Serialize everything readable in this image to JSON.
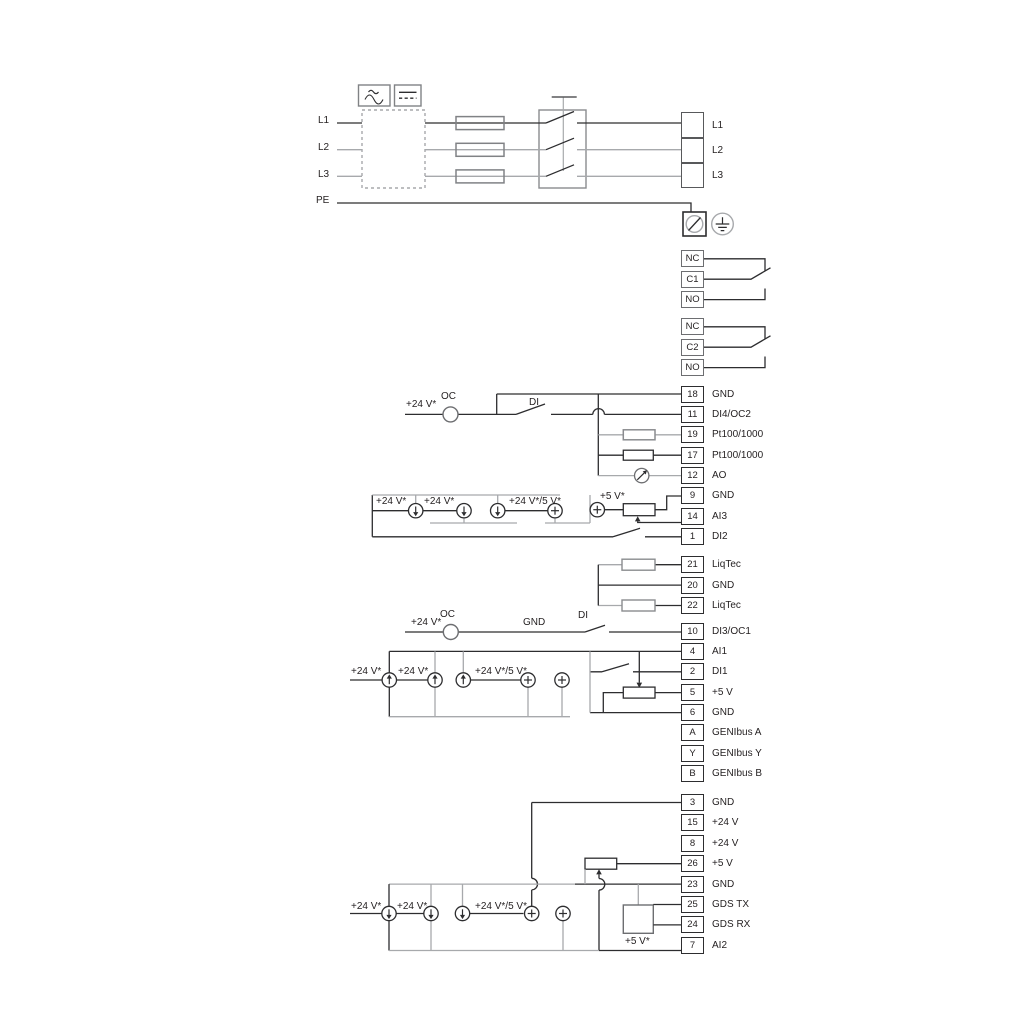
{
  "mains": {
    "input_labels": [
      "L1",
      "L2",
      "L3",
      "PE"
    ],
    "output_rows": [
      {
        "label": "L1"
      },
      {
        "label": "L2"
      },
      {
        "label": "L3"
      }
    ]
  },
  "relays": {
    "relay1_rows": [
      {
        "num": "NC"
      },
      {
        "num": "C1"
      },
      {
        "num": "NO"
      }
    ],
    "relay2_rows": [
      {
        "num": "NC"
      },
      {
        "num": "C2"
      },
      {
        "num": "NO"
      }
    ]
  },
  "io_block_a": {
    "rows": [
      {
        "num": "18",
        "label": "GND"
      },
      {
        "num": "11",
        "label": "DI4/OC2"
      },
      {
        "num": "19",
        "label": "Pt100/1000"
      },
      {
        "num": "17",
        "label": "Pt100/1000"
      },
      {
        "num": "12",
        "label": "AO"
      },
      {
        "num": "9",
        "label": "GND"
      },
      {
        "num": "14",
        "label": "AI3"
      },
      {
        "num": "1",
        "label": "DI2"
      }
    ]
  },
  "liqtec_block": {
    "rows": [
      {
        "num": "21",
        "label": "LiqTec"
      },
      {
        "num": "20",
        "label": "GND"
      },
      {
        "num": "22",
        "label": "LiqTec"
      }
    ]
  },
  "io_block_b": {
    "rows": [
      {
        "num": "10",
        "label": "DI3/OC1"
      },
      {
        "num": "4",
        "label": "AI1"
      },
      {
        "num": "2",
        "label": "DI1"
      },
      {
        "num": "5",
        "label": "+5 V"
      },
      {
        "num": "6",
        "label": "GND"
      },
      {
        "num": "A",
        "label": "GENIbus A"
      },
      {
        "num": "Y",
        "label": "GENIbus Y"
      },
      {
        "num": "B",
        "label": "GENIbus B"
      }
    ]
  },
  "io_block_c": {
    "rows": [
      {
        "num": "3",
        "label": "GND"
      },
      {
        "num": "15",
        "label": "+24 V"
      },
      {
        "num": "8",
        "label": "+24 V"
      },
      {
        "num": "26",
        "label": "+5 V"
      },
      {
        "num": "23",
        "label": "GND"
      },
      {
        "num": "25",
        "label": "GDS TX"
      },
      {
        "num": "24",
        "label": "GDS RX"
      },
      {
        "num": "7",
        "label": "AI2"
      }
    ]
  },
  "annotations": {
    "plus24v": "+24 V*",
    "oc": "OC",
    "di": "DI",
    "gnd": "GND",
    "plus24v_5v": "+24 V*/5 V*",
    "plus5v": "+5 V*"
  },
  "colors": {
    "wire_black": "#2d2d2f",
    "wire_gray": "#a7a9ac",
    "box_gray": "#808285"
  }
}
